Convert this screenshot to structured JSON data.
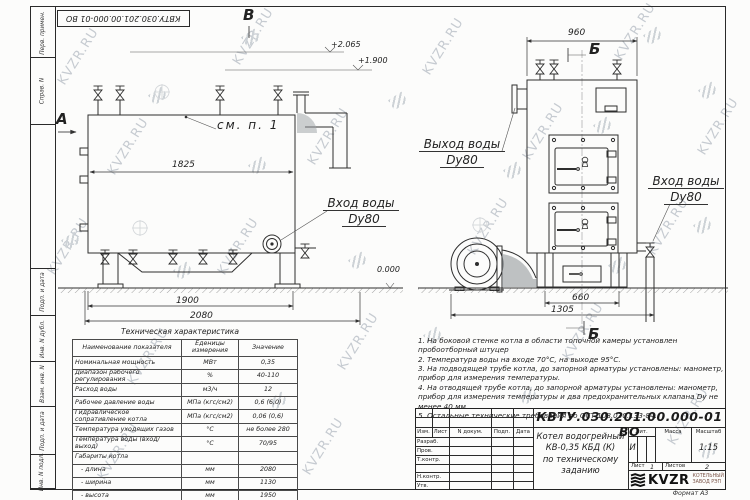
{
  "watermark": {
    "text": "KVZR.RU"
  },
  "frame": {
    "top_stamp": "КВТУ.030.201.00.000-01 ВО",
    "margin_fields": [
      "Перв. примен.",
      "Справ. N",
      "Подп. и дата",
      "Инв. N дубл.",
      "Взам. инв. N",
      "Подп. и дата",
      "Инв. N подл."
    ],
    "format_note": "Формат  А3"
  },
  "views": {
    "left": {
      "section_a": "А",
      "section_b": "В",
      "see_note": "см. п. 1",
      "dim_inner": "1825",
      "dim_1900": "1900",
      "dim_2080": "2080",
      "elev_top": "+2.065",
      "elev_mid": "+1.900",
      "elev_zero": "0.000",
      "inlet_label": "Вход воды",
      "inlet_dn": "Dу80"
    },
    "right": {
      "dim_960": "960",
      "section_b_top": "Б",
      "section_b_bottom": "Б",
      "outlet_label": "Выход воды",
      "outlet_dn": "Dу80",
      "inlet_label": "Вход воды",
      "inlet_dn": "Dу80",
      "dim_660": "660",
      "dim_1305": "1305"
    }
  },
  "tech_table": {
    "title": "Техническая характеристика",
    "col_name": "Наименование показателя",
    "col_units_1": "Еденицы",
    "col_units_2": "измерения",
    "col_value": "Значение",
    "rows": [
      {
        "name": "Номинальная мощность",
        "units": "МВт",
        "value": "0,35"
      },
      {
        "name": "Диапазон рабочего регулирования",
        "units": "%",
        "value": "40-110"
      },
      {
        "name": "Расход воды",
        "units": "м3/ч",
        "value": "12"
      },
      {
        "name": "Рабочее давление воды",
        "units": "МПа (кгс/см2)",
        "value": "0,6 (6,0)"
      },
      {
        "name": "Гидравлическое сопративление котла",
        "units": "МПа (кгс/см2)",
        "value": "0,06 (0,6)"
      },
      {
        "name": "Температура уходящих газов",
        "units": "°С",
        "value": "не более 280"
      },
      {
        "name": "Температура воды (вход/выход)",
        "units": "°С",
        "value": "70/95"
      },
      {
        "name": "Габариты котла",
        "units": "",
        "value": ""
      },
      {
        "name": "- длина",
        "units": "мм",
        "value": "2080"
      },
      {
        "name": "- ширина",
        "units": "мм",
        "value": "1130"
      },
      {
        "name": "- высота",
        "units": "мм",
        "value": "1950"
      }
    ]
  },
  "notes": [
    "1.  На боковой стенке котла в области топочной камеры установлен пробоотборный штуцер",
    "2.  Температура воды на входе 70°С, на выходе 95°С.",
    "3.  На подводящей трубе котла, до запорной арматуры установлены: манометр, прибор для измерения температуры.",
    "4.  На отводящей трубе котла, до запорной арматуры установлены: манометр, прибор для измерения температуры и два предохранительных клапана Dу не менее 40 мм.",
    "5.  Остальные технические требования по ОСТ 108.030.133-84."
  ],
  "title_block": {
    "doc_number": "КВТУ.030.201.00.000-01 ВО",
    "product_line1": "Котел водогрейный",
    "product_line2": "КВ-0,35 КБД (К)",
    "product_line3": "по техническому заданию",
    "col_izm": "Изм.",
    "col_list": "Лист",
    "col_ndoc": "N докум.",
    "col_podp": "Подп.",
    "col_data": "Дата",
    "row_razrab": "Разраб.",
    "row_prov": "Пров.",
    "row_tkontr": "Т.контр.",
    "row_nkontr": "Н.контр.",
    "row_utv": "Утв.",
    "lit_header": "Лит.",
    "mass_header": "Масса",
    "scale_header": "Масштаб",
    "lit_value": "И",
    "scale_value": "1:15",
    "sheet_label": "Лист",
    "sheet_value": "1",
    "sheets_label": "Листов",
    "sheets_value": "2",
    "company_name": "KVZR",
    "company_sub1": "КОТЕЛЬНЫЙ",
    "company_sub2": "ЗАВОД РЭП"
  }
}
